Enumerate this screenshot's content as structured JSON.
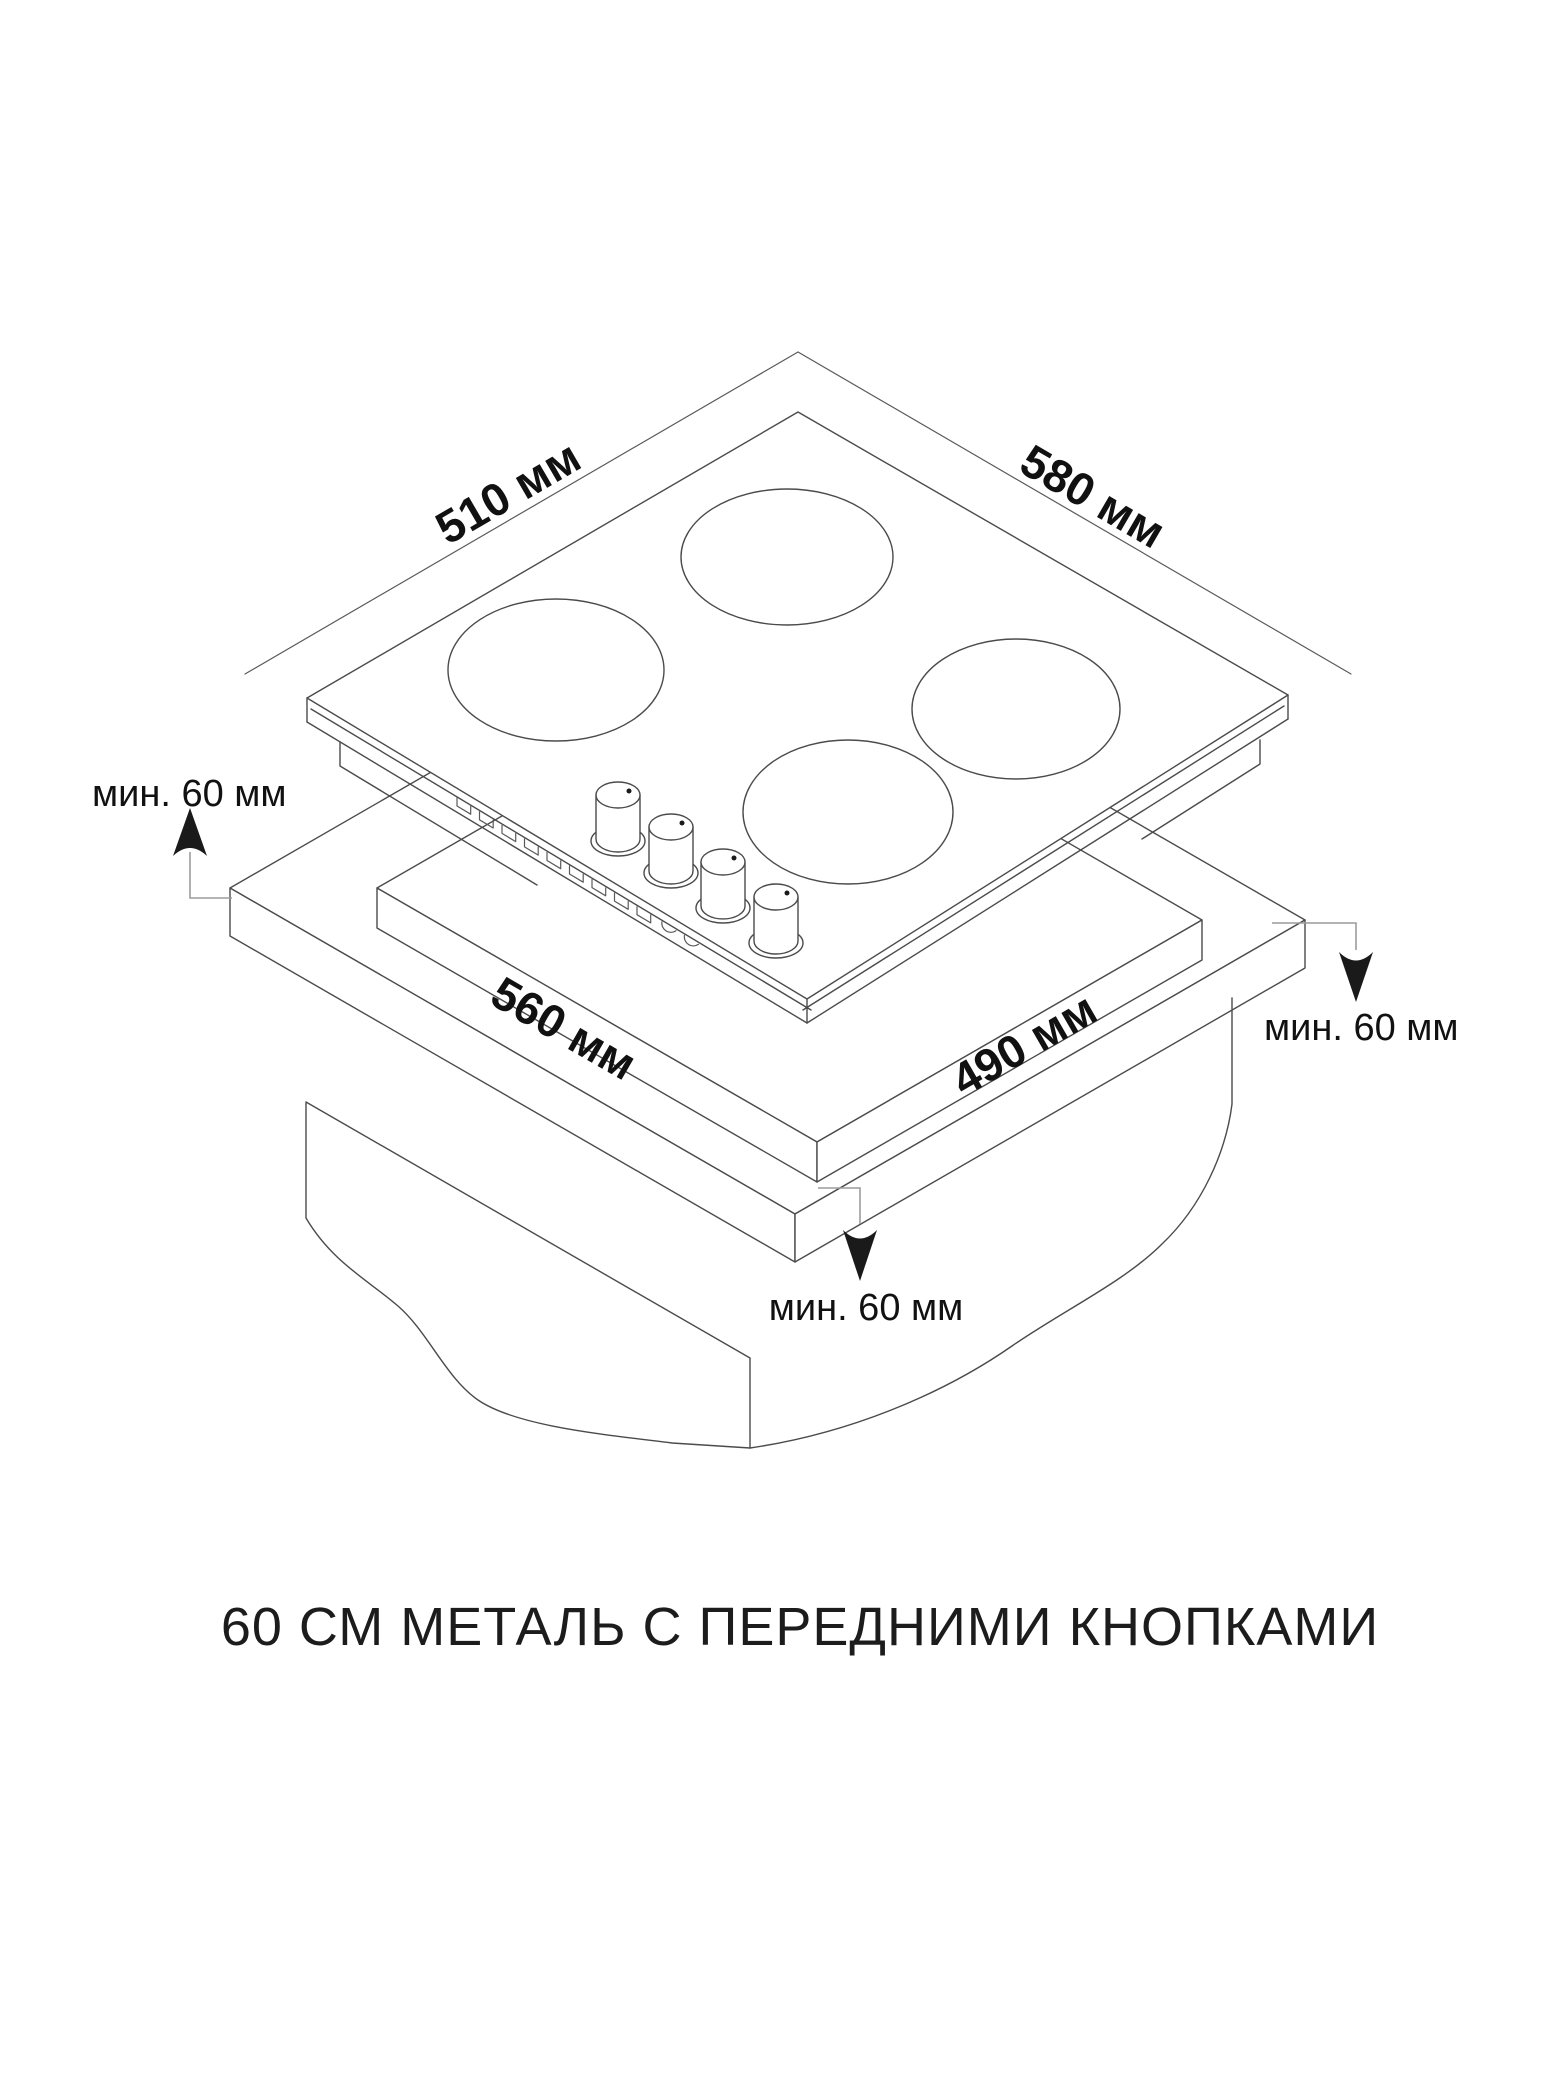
{
  "page": {
    "background": "#ffffff"
  },
  "diagram": {
    "caption": "60 СМ МЕТАЛЬ С ПЕРЕДНИМИ КНОПКАМИ",
    "dimensions": {
      "hob_depth": "510 мм",
      "hob_width": "580 мм",
      "cutout_width": "560 мм",
      "cutout_depth": "490 мм"
    },
    "clearances": {
      "back": "мин. 60 мм",
      "right": "мин. 60 мм",
      "front": "мин. 60 мм"
    },
    "colors": {
      "outline": "#4b4b4b",
      "leader": "#9c9c9c",
      "ink": "#111111",
      "background": "#ffffff"
    }
  }
}
